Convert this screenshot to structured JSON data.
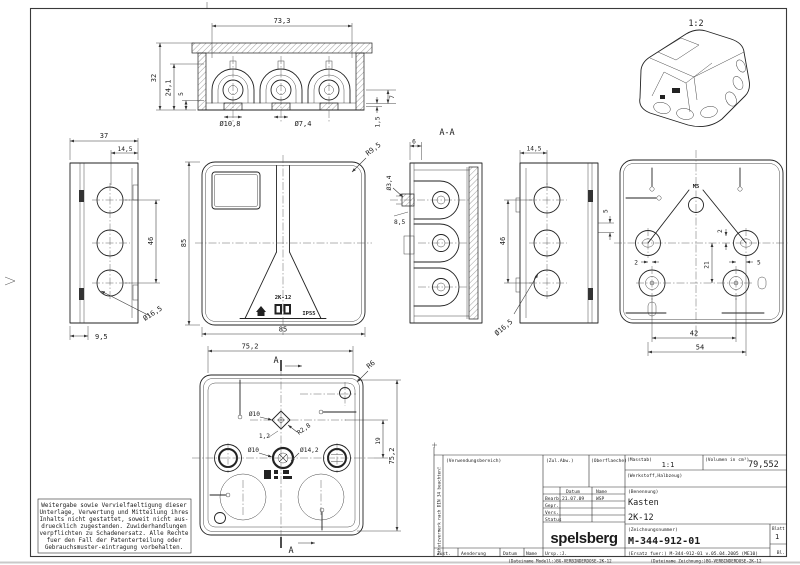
{
  "drawing": {
    "iso_scale": "1:2",
    "section_title": "A-A",
    "views": {
      "top": {
        "dim_width": "73,3",
        "dim_height": "32",
        "dim_inner": "24,1",
        "dim_foot": "5",
        "dia_left": "Ø10,8",
        "dia_center": "Ø7,4",
        "dim_right": "7",
        "dim_lip": "1,5"
      },
      "left": {
        "dim_depth": "37",
        "dim_offset": "14,5",
        "dim_pitch": "46",
        "dia_knockout": "Ø16,5",
        "dim_lid": "9,5"
      },
      "front": {
        "dim_height": "85",
        "dim_width": "85",
        "dim_corner": "R9,5",
        "model": "2K-12",
        "ip": "IP55"
      },
      "section": {
        "dim_top": "6",
        "dia_hole": "Ø3,4",
        "dim_step": "8,5"
      },
      "right": {
        "dim_offset": "14,5",
        "dim_pitch": "46",
        "dia_knockout": "Ø16,5",
        "dim_edge": "5"
      },
      "rear": {
        "thread": "M5",
        "off_left": "2",
        "off_top": "2",
        "dim_center": "21",
        "off_right": "5",
        "pitch_inner": "42",
        "pitch_outer": "54"
      },
      "bottom": {
        "dim_width": "75,2",
        "dim_height": "75,2",
        "corner": "R6",
        "dia_boss": "Ø10",
        "dim_web": "1,2",
        "fillet": "R2,8",
        "dia_hub_hole": "Ø10",
        "dia_hub": "Ø14,2",
        "dim_offset": "19",
        "arrow": "A"
      }
    }
  },
  "disclaimer": {
    "lines": [
      "Weitergabe sowie Vervielfaeltigung dieser",
      "Unterlage, Verwertung und Mitteilung ihres",
      "Inhalts nicht gestattet, soweit nicht aus-",
      "druecklich zugestanden. Zuwiderhandlungen",
      "verpflichten zu Schadenersatz. Alle Rechte",
      "fuer den Fall der Patenterteilung oder",
      "Gebrauchsmuster-eintragung vorbehalten."
    ]
  },
  "titleblock": {
    "vertical_note": "Schutzvermerk nach DIN 34 beachten!",
    "verwendungsbereich": "(Verwendungsbereich)",
    "zul_abw": "(Zul.Abw.)",
    "oberflaeche": "(Oberflaeche)",
    "masstab_label": "(Masstab)",
    "masstab_value": "1:1",
    "volumen_label": "(Volumen in cm³)",
    "volumen_value": "79,552",
    "werkstoff": "(Werkstoff,Halbzeug)",
    "col_datum": "Datum",
    "col_name": "Name",
    "row_bearb": "Bearb.",
    "bearb_datum": "21.07.09",
    "bearb_name": "WSP",
    "row_gepr": "Gepr.",
    "row_vers": "Vers.",
    "row_status": "Status",
    "benennung_label": "(Benennung)",
    "benennung_line1": "Kasten",
    "benennung_line2": "2K-12",
    "logo": "spelsberg",
    "zeichnungsnummer_label": "(Zeichnungsnummer)",
    "zeichnungsnummer": "M-344-912-01",
    "blatt_label": "Blatt",
    "blatt_value": "1",
    "bl_label": "Bl.",
    "zust": "Zust.",
    "aenderung": "Aenderung",
    "datum": "Datum",
    "name": "Name",
    "ursp": "Ursp.:J.",
    "ersatz": "(Ersatz fuer:)  M-344-912-01 v.05.04.2005 (ME10)",
    "file_model": "(Dateiname Modell:)BG-VERBINDERDOSE-2K-12",
    "file_drawing": "(Dateiname Zeichnung:)BG-VERBINDERDOSE-2K-12"
  }
}
